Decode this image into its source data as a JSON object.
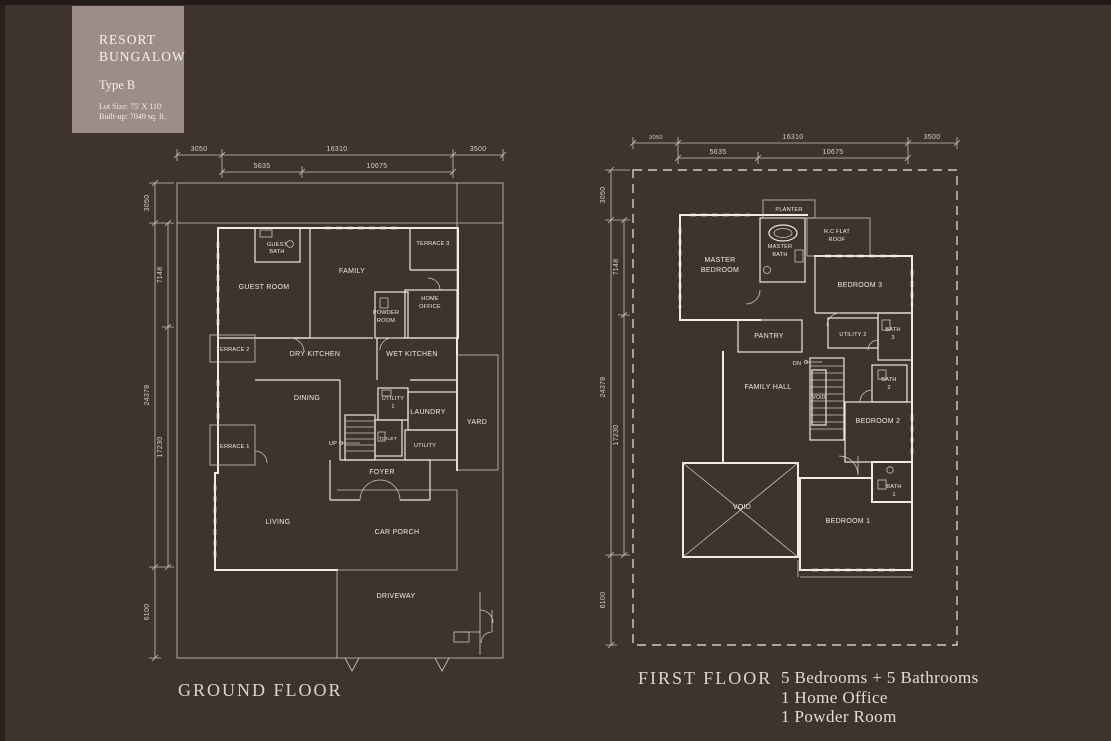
{
  "title_card": {
    "line1": "RESORT",
    "line2": "BUNGALOW",
    "type": "Type B",
    "lot_size": "Lot Size: 75' X 110'",
    "built_up": "Built-up: 7049 sq. ft."
  },
  "ground": {
    "name": "GROUND FLOOR",
    "dims": {
      "top": [
        "3050",
        "16310",
        "3500"
      ],
      "top2": [
        "5635",
        "10675"
      ],
      "left": [
        "3050",
        "7148",
        "24378",
        "17230",
        "6100"
      ]
    },
    "rooms": {
      "guest_bath": [
        "GUEST",
        "BATH"
      ],
      "guest_room": "GUEST ROOM",
      "family": "FAMILY",
      "terrace3": "TERRACE 3",
      "home_office": [
        "HOME",
        "OFFICE"
      ],
      "powder_room": [
        "POWDER",
        "ROOM"
      ],
      "terrace2": "TERRACE 2",
      "dry_kitchen": "DRY KITCHEN",
      "wet_kitchen": "WET KITCHEN",
      "dining": "DINING",
      "utility1": [
        "UTILITY",
        "1"
      ],
      "laundry": "LAUNDRY",
      "yard": "YARD",
      "terrace1": "TERRACE 1",
      "up": "UP",
      "toilet": "TOILET",
      "utility": "UTILITY",
      "foyer": "FOYER",
      "living": "LIVING",
      "car_porch": "CAR PORCH",
      "driveway": "DRIVEWAY"
    }
  },
  "first": {
    "name": "FIRST FLOOR",
    "dims": {
      "top": [
        "3050",
        "16310",
        "3500"
      ],
      "top2": [
        "5635",
        "10675"
      ],
      "left": [
        "3050",
        "7148",
        "24378",
        "17230",
        "6100"
      ]
    },
    "rooms": {
      "planter": "PLANTER",
      "master_bath": [
        "MASTER",
        "BATH"
      ],
      "rc_flat_roof": [
        "R.C FLAT",
        "ROOF"
      ],
      "master_bedroom": [
        "MASTER",
        "BEDROOM"
      ],
      "bedroom3": "BEDROOM 3",
      "pantry": "PANTRY",
      "utility2": "UTILITY 2",
      "bath3": [
        "BATH",
        "3"
      ],
      "dn": "DN",
      "family_hall": "FAMILY HALL",
      "void_stair": "VOID",
      "bath2": [
        "BATH",
        "2"
      ],
      "bedroom2": "BEDROOM 2",
      "void": "VOID",
      "bedroom1": "BEDROOM 1",
      "bath1": [
        "BATH",
        "1"
      ]
    }
  },
  "summary": {
    "line1": "5 Bedrooms + 5 Bathrooms",
    "line2": "1 Home Office",
    "line3": "1 Powder Room"
  }
}
